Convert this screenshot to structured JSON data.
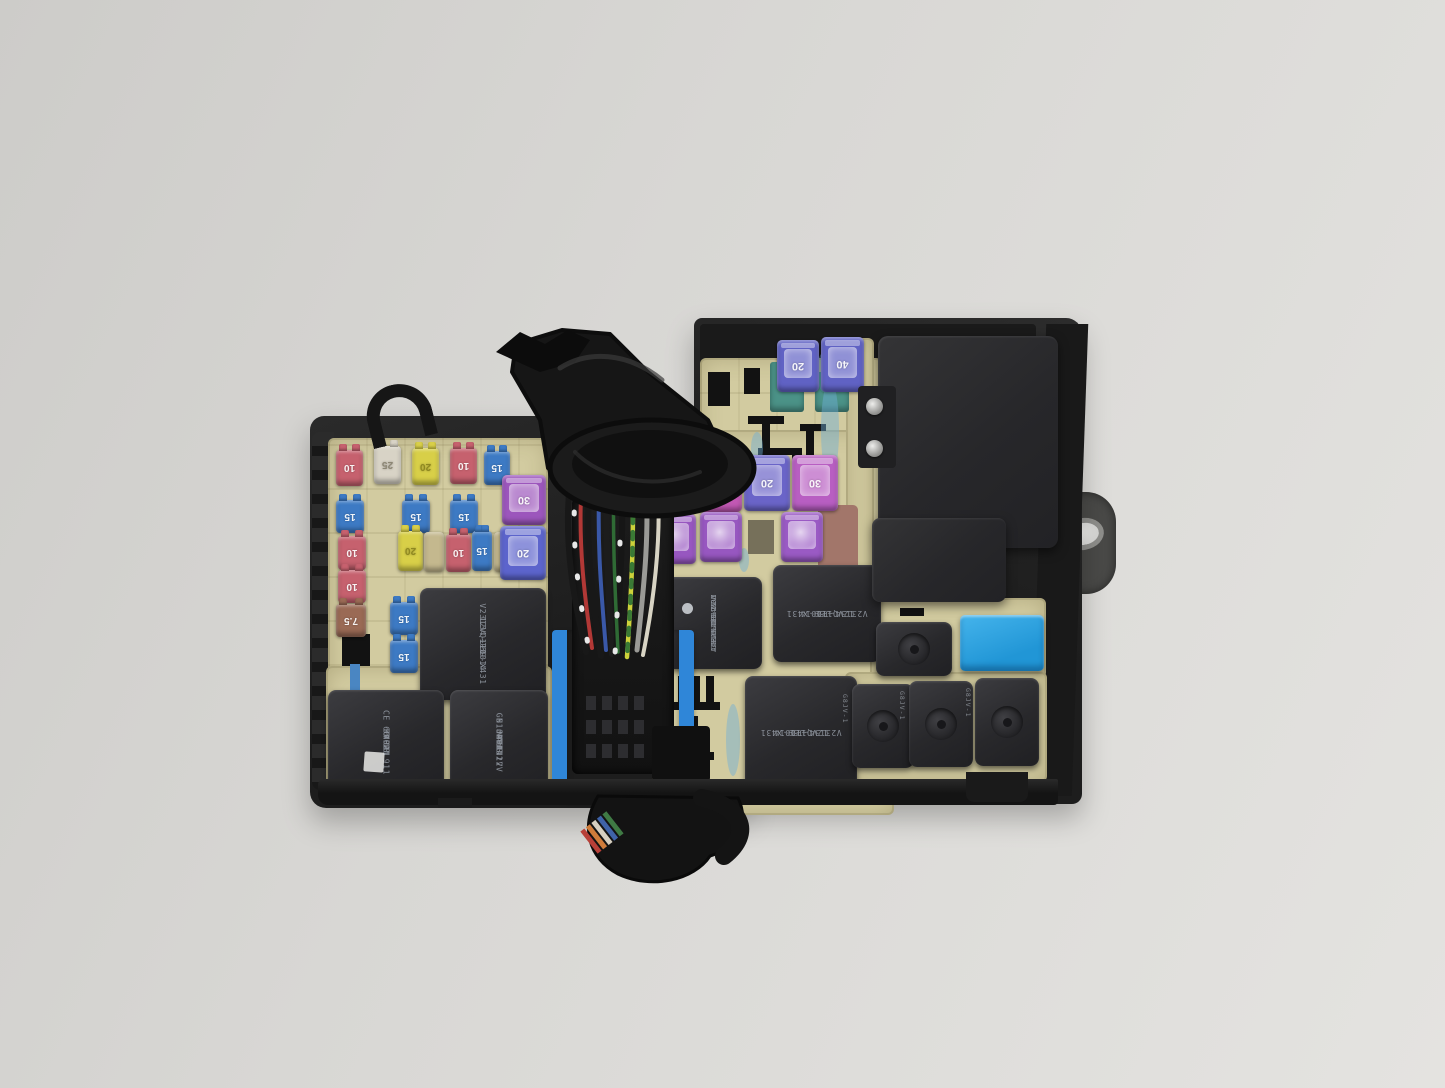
{
  "scene": {
    "subject": "engine-bay fuse and relay junction box photographed on a light gray surface"
  },
  "colors": {
    "housing": "#1d1d1d",
    "panel_beige": "#d2cba0",
    "connector_lock_blue": "#2f86d8",
    "blue_relay": "#2aa2e2",
    "teal_fuse_base": "#4b9287",
    "paint_mark_blue": "#6eafd7",
    "background": "#d8d7d4"
  },
  "fuses": [
    {
      "t": "mini",
      "label": "10",
      "color": "#c6616e",
      "x": 336,
      "y": 450,
      "w": 27,
      "h": 36
    },
    {
      "t": "mini",
      "label": "25",
      "color": "#d8d3c6",
      "tc": "#8c8674",
      "x": 374,
      "y": 446,
      "w": 27,
      "h": 38
    },
    {
      "t": "mini",
      "label": "20",
      "color": "#d8cf48",
      "tc": "#8f8820",
      "x": 412,
      "y": 448,
      "w": 27,
      "h": 37
    },
    {
      "t": "mini",
      "label": "10",
      "color": "#c6616e",
      "x": 450,
      "y": 448,
      "w": 27,
      "h": 36
    },
    {
      "t": "mini",
      "label": "15",
      "color": "#3d7ac4",
      "x": 484,
      "y": 451,
      "w": 26,
      "h": 34
    },
    {
      "t": "mini",
      "label": "15",
      "color": "#3d7ac4",
      "x": 336,
      "y": 500,
      "w": 28,
      "h": 33
    },
    {
      "t": "mini",
      "label": "15",
      "color": "#3d7ac4",
      "x": 402,
      "y": 500,
      "w": 28,
      "h": 33
    },
    {
      "t": "mini",
      "label": "15",
      "color": "#3d7ac4",
      "x": 450,
      "y": 500,
      "w": 28,
      "h": 33
    },
    {
      "t": "mini",
      "label": "10",
      "color": "#c6616e",
      "x": 338,
      "y": 536,
      "w": 28,
      "h": 34
    },
    {
      "t": "mini",
      "label": "20",
      "color": "#d8cf48",
      "tc": "#8f8820",
      "x": 398,
      "y": 531,
      "w": 25,
      "h": 40
    },
    {
      "t": "tan",
      "label": "",
      "color": "#c4b88e",
      "x": 424,
      "y": 532,
      "w": 20,
      "h": 40
    },
    {
      "t": "mini",
      "label": "10",
      "color": "#c6616e",
      "x": 446,
      "y": 534,
      "w": 25,
      "h": 38
    },
    {
      "t": "mini",
      "label": "15",
      "color": "#3d7ac4",
      "x": 472,
      "y": 531,
      "w": 20,
      "h": 40
    },
    {
      "t": "tan",
      "label": "",
      "color": "#c4b88e",
      "x": 494,
      "y": 532,
      "w": 20,
      "h": 40
    },
    {
      "t": "mini",
      "label": "10",
      "color": "#c6616e",
      "x": 338,
      "y": 570,
      "w": 28,
      "h": 33
    },
    {
      "t": "mini",
      "label": "7.5",
      "color": "#9a6a55",
      "x": 336,
      "y": 604,
      "w": 30,
      "h": 33
    },
    {
      "t": "mini",
      "label": "15",
      "color": "#3d7ac4",
      "x": 390,
      "y": 602,
      "w": 28,
      "h": 33
    },
    {
      "t": "mini",
      "label": "15",
      "color": "#3d7ac4",
      "x": 390,
      "y": 640,
      "w": 28,
      "h": 33
    },
    {
      "t": "mcase",
      "label": "30",
      "color": "#9c56bc",
      "x": 502,
      "y": 475,
      "w": 44,
      "h": 50
    },
    {
      "t": "mcase",
      "label": "20",
      "color": "#5c64cc",
      "x": 500,
      "y": 526,
      "w": 46,
      "h": 54
    },
    {
      "t": "jcase",
      "label": "20",
      "color": "#6062c4",
      "x": 777,
      "y": 340,
      "w": 42,
      "h": 52
    },
    {
      "t": "jcase",
      "label": "40",
      "color": "#6062c4",
      "x": 821,
      "y": 337,
      "w": 43,
      "h": 55
    },
    {
      "t": "jcase",
      "label": "40",
      "color": "#7a5fc6",
      "x": 648,
      "y": 458,
      "w": 46,
      "h": 56
    },
    {
      "t": "jcase",
      "label": "30",
      "color": "#c258b4",
      "x": 696,
      "y": 456,
      "w": 46,
      "h": 56
    },
    {
      "t": "jcase",
      "label": "20",
      "color": "#6a64c8",
      "x": 744,
      "y": 455,
      "w": 46,
      "h": 56
    },
    {
      "t": "jcase",
      "label": "30",
      "color": "#b85ec2",
      "x": 792,
      "y": 455,
      "w": 46,
      "h": 56
    },
    {
      "t": "jcase2",
      "label": "",
      "color": "#9757c0",
      "x": 654,
      "y": 514,
      "w": 42,
      "h": 50
    },
    {
      "t": "jcase2",
      "label": "",
      "color": "#9757c0",
      "x": 700,
      "y": 512,
      "w": 42,
      "h": 50
    },
    {
      "t": "jcase2",
      "label": "",
      "color": "#9a5ac4",
      "x": 781,
      "y": 512,
      "w": 42,
      "h": 50
    }
  ],
  "relays": {
    "left_center": {
      "lines": [
        "Q110",
        "V23134-J59-X431",
        "12V ++1014"
      ]
    },
    "bottom_left_a": {
      "lines": [
        "CE 66 18 911",
        "KV021",
        "M03",
        "JAPAN"
      ]
    },
    "bottom_left_b": {
      "lines": [
        "NAiS",
        "N.O.DC12V",
        "GB1a-TR-12V",
        "M01",
        "JAPAN"
      ]
    },
    "mid_nais": {
      "lines": [
        "NAiS",
        "N.O.DC12V",
        "GB1a-TR-12V",
        "ACB36221 M01",
        "JAPAN 0042DM"
      ]
    },
    "mid_right": {
      "lines": [
        "12V ++1014",
        "V23134-J59-X431",
        "Q110"
      ]
    },
    "bottom_mid": {
      "lines": [
        "12V ++1014",
        "V23134-J59-X431",
        "Q110"
      ]
    },
    "small_side_marking": "G8JV-1"
  }
}
